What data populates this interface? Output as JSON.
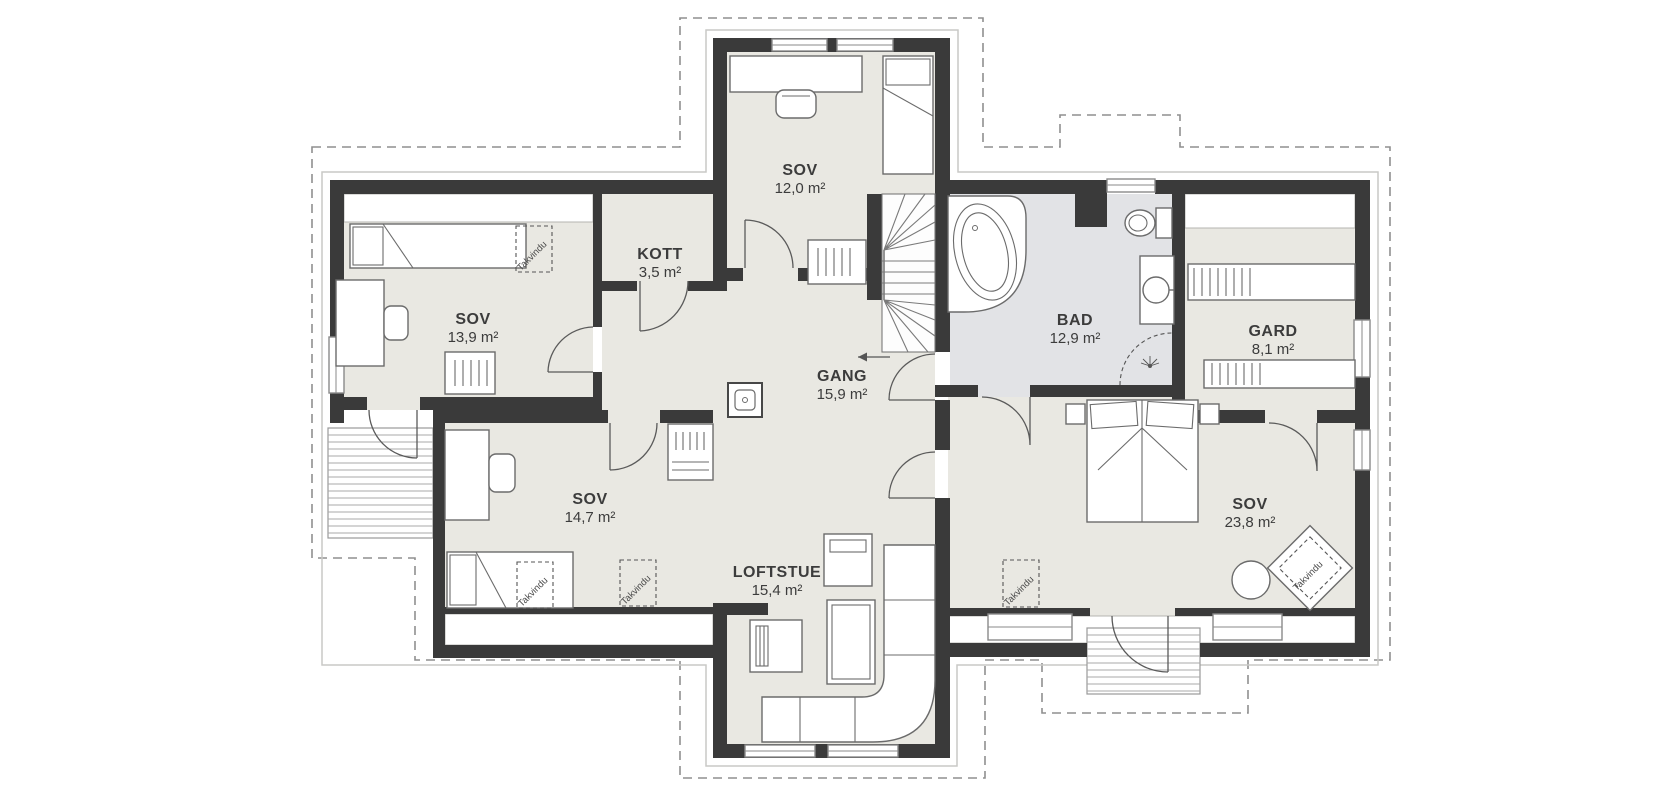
{
  "plan": {
    "rooms": [
      {
        "id": "sov-top",
        "name": "SOV",
        "area": "12,0 m²"
      },
      {
        "id": "sov-left",
        "name": "SOV",
        "area": "13,9 m²"
      },
      {
        "id": "kott",
        "name": "KOTT",
        "area": "3,5 m²"
      },
      {
        "id": "gang",
        "name": "GANG",
        "area": "15,9 m²"
      },
      {
        "id": "bad",
        "name": "BAD",
        "area": "12,9 m²"
      },
      {
        "id": "gard",
        "name": "GARD",
        "area": "8,1 m²"
      },
      {
        "id": "sov-mid-left",
        "name": "SOV",
        "area": "14,7 m²"
      },
      {
        "id": "loftstue",
        "name": "LOFTSTUE",
        "area": "15,4 m²"
      },
      {
        "id": "sov-right",
        "name": "SOV",
        "area": "23,8 m²"
      }
    ],
    "annotations": {
      "roof_window": "Takvindu"
    },
    "colors": {
      "floor": "#e9e8e2",
      "wet_room_floor": "#e2e3e6",
      "wall": "#3a3a3a",
      "roof_outline": "#8f8f8f",
      "label_text": "#3c3c3c"
    }
  }
}
